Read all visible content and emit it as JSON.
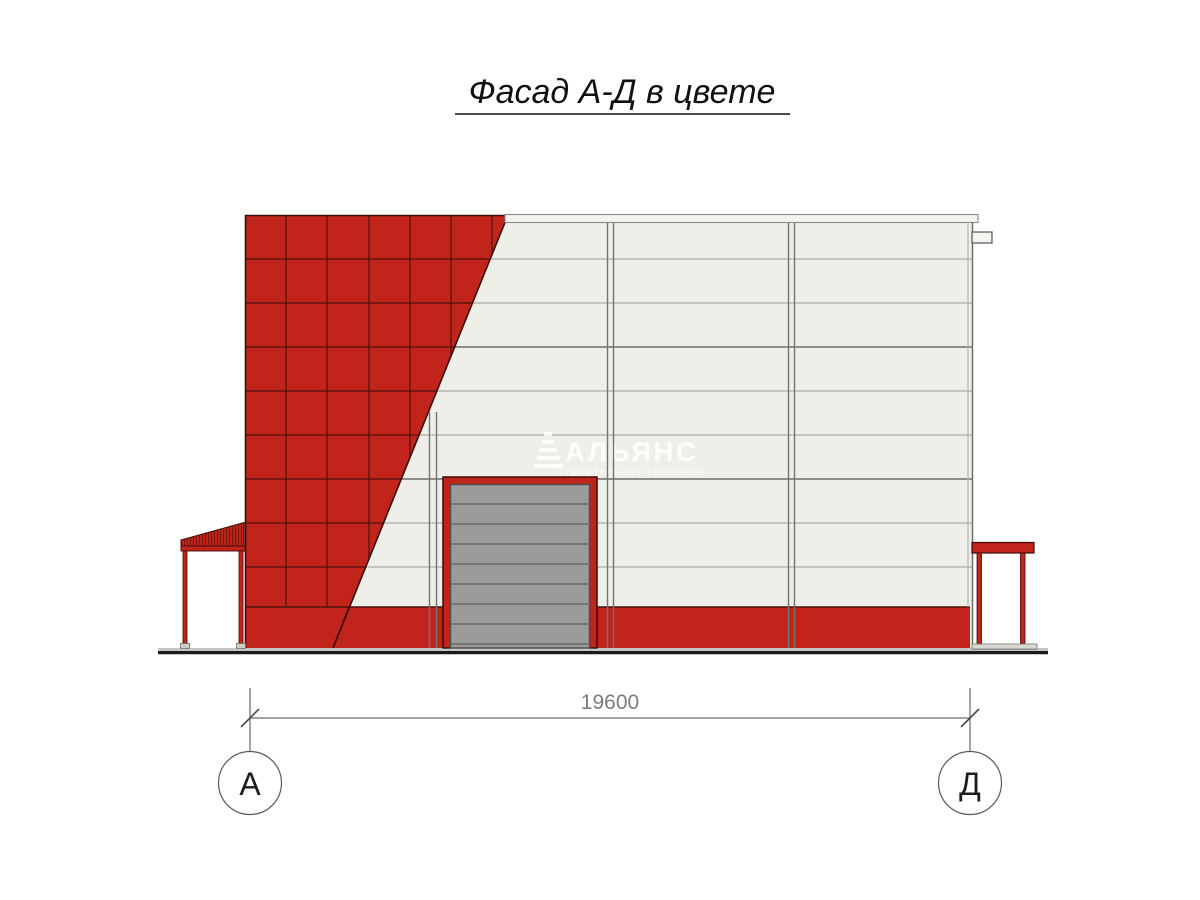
{
  "title": {
    "text": "Фасад А-Д в цвете"
  },
  "dimension": {
    "value": "19600"
  },
  "axes": {
    "left": "А",
    "right": "Д"
  },
  "watermark": {
    "name": "АЛЬЯНС",
    "tagline": "строительная компания"
  },
  "colors": {
    "cladding_red": "#c0241a",
    "tile_joint": "#4e100a",
    "dark_edge": "#3d0c07",
    "panel_light": "#efefe9",
    "panel_line": "#acaca6",
    "girt_line": "#7f7f78",
    "mullion": "#74746d",
    "door_gray": "#9b9b9b",
    "door_slat_line": "#6a6a6a",
    "cap": "#f3f3ef",
    "ground": "#1b1b1b",
    "dim_gray": "#4a4a4a"
  }
}
